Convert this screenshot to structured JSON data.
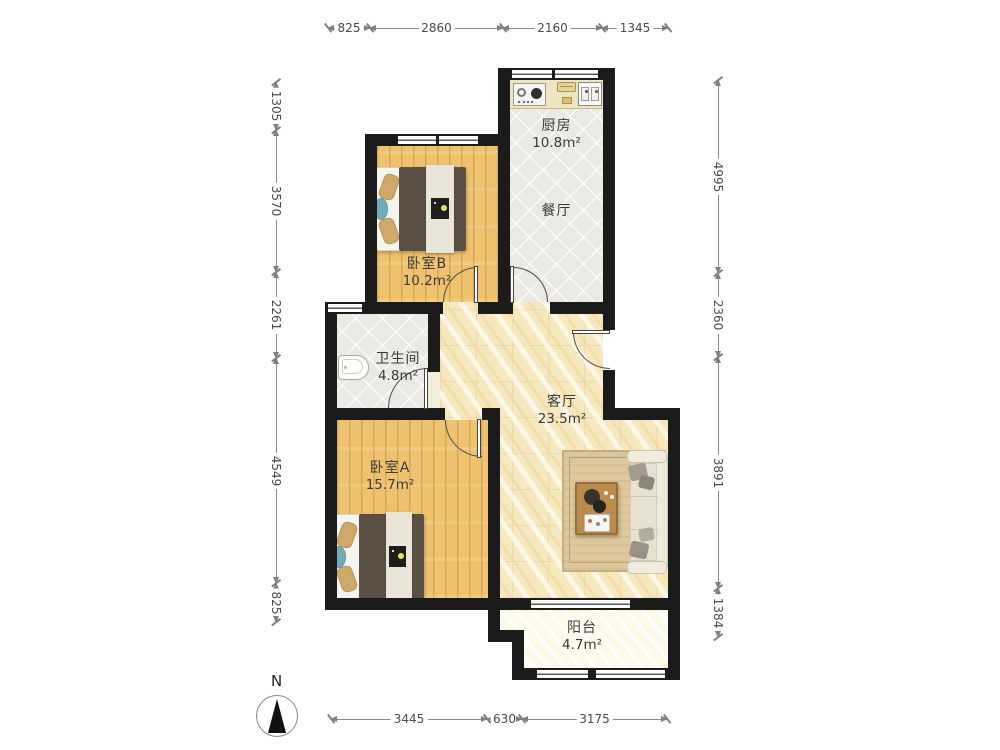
{
  "compass": {
    "label": "N"
  },
  "rooms": {
    "kitchen": {
      "name": "厨房",
      "area": "10.8m²"
    },
    "dining": {
      "name": "餐厅"
    },
    "bedroom_b": {
      "name": "卧室B",
      "area": "10.2m²"
    },
    "bathroom": {
      "name": "卫生间",
      "area": "4.8m²"
    },
    "living": {
      "name": "客厅",
      "area": "23.5m²"
    },
    "bedroom_a": {
      "name": "卧室A",
      "area": "15.7m²"
    },
    "balcony": {
      "name": "阳台",
      "area": "4.7m²"
    }
  },
  "dimensions_mm": {
    "top": [
      "825",
      "2860",
      "2160",
      "1345"
    ],
    "left": [
      "1305",
      "3570",
      "2261",
      "4549",
      "825"
    ],
    "right": [
      "4995",
      "2360",
      "3891",
      "1384"
    ],
    "bottom": [
      "3445",
      "630",
      "3175"
    ]
  },
  "colors": {
    "wall": "#1b1b1b",
    "wood_floor": "#eec26e",
    "tile_floor": "#eae9e4",
    "living_floor": "#f7e8bf",
    "balcony_floor": "#fcfbe9",
    "counter": "#efe5c0",
    "rug": "#dcc79e",
    "blanket": "#5b5044",
    "accent_teal": "#72adba"
  }
}
